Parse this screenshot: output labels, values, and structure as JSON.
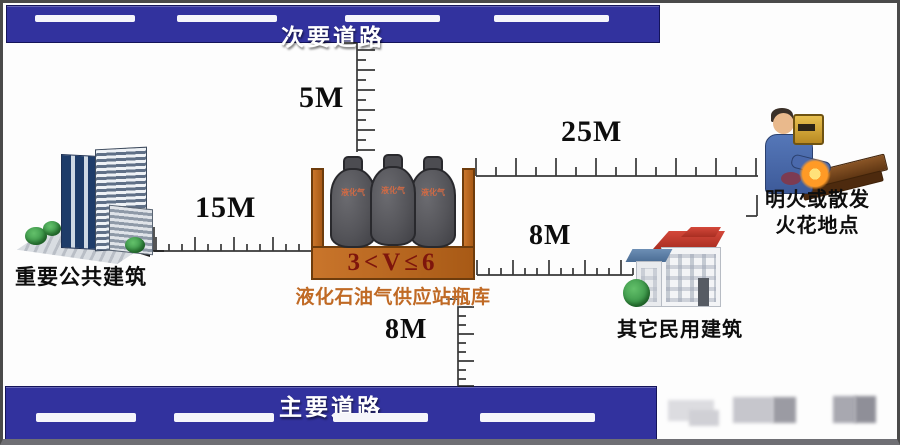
{
  "roads": {
    "secondary": "次要道路",
    "main": "主要道路"
  },
  "distances": {
    "secondary_road": "5M",
    "public_building": "15M",
    "open_flame": "25M",
    "civil_building": "8M",
    "main_road": "8M"
  },
  "station": {
    "volume": "3<V≤6",
    "caption": "液化石油气供应站瓶库",
    "cylinder_label": "液化气"
  },
  "landmarks": {
    "public_building": "重要公共建筑",
    "open_flame_line1": "明火或散发",
    "open_flame_line2": "火花地点",
    "civil_building": "其它民用建筑"
  },
  "colors": {
    "road": "#32329e",
    "container": "#b5651d",
    "volume_text": "#7e150c",
    "caption_text": "#c06a25",
    "road_text": "#ffffff"
  }
}
